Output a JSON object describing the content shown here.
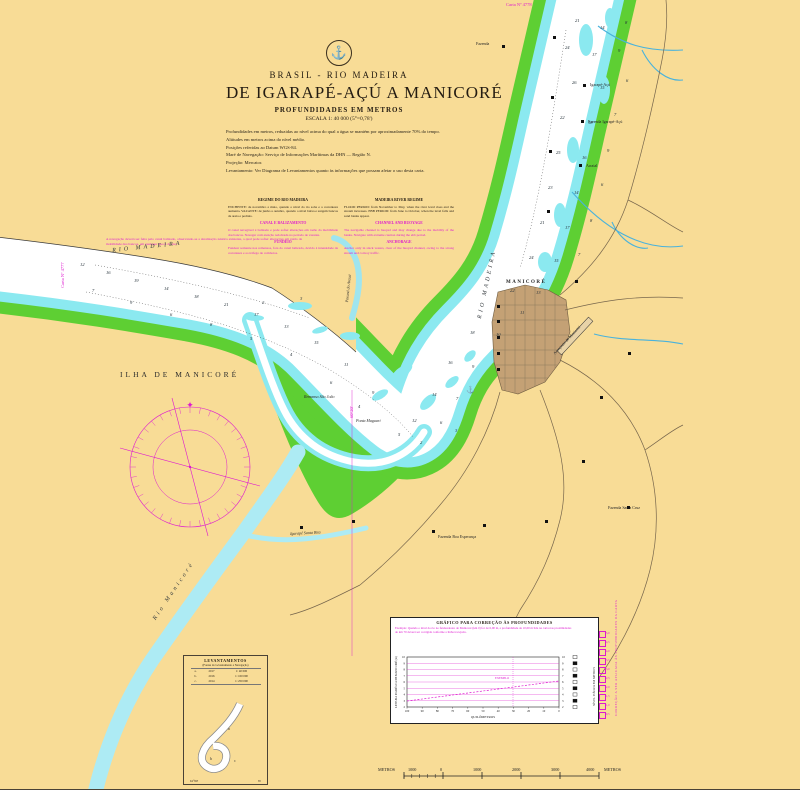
{
  "chart": {
    "country_line": "BRASIL - RIO MADEIRA",
    "title": "DE IGARAPÉ-AÇÚ A MANICORÉ",
    "subtitle1": "PROFUNDIDADES EM METROS",
    "subtitle2": "ESCALA 1: 40 000 (5°=0,78')",
    "emblem_icon": "anchor-icon",
    "notes": [
      "Profundidades em metros, reduzidas ao nível acima do qual a água se mantém por aproximadamente 70% do tempo.",
      "Altitudes em metros acima do nível médio.",
      "Posições referidas ao Datum WGS-84.",
      "Maré de Navegação: Serviço de Informações Marítimas da DHN — Região N.",
      "Projeção: Mercator.",
      "Levantamento: Ver Diagrama de Levantamentos quanto às informações que possam afetar o uso desta carta."
    ]
  },
  "notes_block": {
    "left": {
      "title": "REGIME DO RIO MADEIRA",
      "p1": "ENCHENTE: de novembro a maio, quando o nível do rio sobe e a correnteza aumenta. VAZANTE: de junho a outubro, quando o nível baixa e surgem bancos de areia e pedrais.",
      "h2": "CANAL E BALIZAMENTO",
      "p2": "O canal navegável é balizado e pode sofrer alterações em razão da mobilidade dos bancos. Navegar com atenção redobrada no período de vazante.",
      "h3": "FUNDEIO",
      "p3": "Fundear somente nos remansos, fora do canal balizado, devido à intensidade da correnteza e ao tráfego de comboios."
    },
    "right": {
      "title": "MADEIRA RIVER REGIME",
      "p1": "FLOOD PERIOD: from November to May, when the river level rises and the stream increases. EBB PERIOD: from June to October, when the level falls and sand banks appear.",
      "h2": "CHANNEL AND BUOYAGE",
      "p2": "The navigable channel is buoyed and may change due to the mobility of the banks. Navigate with extreme caution during the ebb period.",
      "h3": "ANCHORAGE",
      "p3": "Anchor only in slack waters, clear of the buoyed channel, owing to the strong stream and convoy traffic."
    }
  },
  "river_note": "A navegação deverá ser feita pelo canal balizado, observando-se a sinalização náutica existente, a qual pode sofrer alterações em razão da mobilidade dos bancos, em qualquer época do ano.",
  "map_labels": [
    {
      "t": "Carta Nº 4778",
      "x": 506,
      "y": 2,
      "c": "c-mag"
    },
    {
      "t": "Carta Nº 4777",
      "x": 60,
      "y": 288,
      "r": -90,
      "c": "c-mag"
    },
    {
      "t": "Fazenda",
      "x": 476,
      "y": 41,
      "c": "c-pl"
    },
    {
      "t": "Igarapé-Açú",
      "x": 590,
      "y": 82,
      "c": "c-pl"
    },
    {
      "t": "Fazenda Igarapé-Açú",
      "x": 588,
      "y": 119,
      "c": "c-pl"
    },
    {
      "t": "Arraial",
      "x": 586,
      "y": 163,
      "c": "c-pl"
    },
    {
      "t": "RIO MADEIRA",
      "x": 112,
      "y": 248,
      "r": -6,
      "c": "c-wat"
    },
    {
      "t": "RIO MADEIRA",
      "x": 477,
      "y": 318,
      "r": -78,
      "c": "c-wat"
    },
    {
      "t": "ILHA DE MANICORÉ",
      "x": 120,
      "y": 370,
      "c": "c-isl"
    },
    {
      "t": "MANICORÉ",
      "x": 506,
      "y": 280,
      "c": "c-city"
    },
    {
      "t": "Remanso São João",
      "x": 304,
      "y": 394,
      "c": "c-pli"
    },
    {
      "t": "Ponta Maguari",
      "x": 356,
      "y": 418,
      "c": "c-pli"
    },
    {
      "t": "Paraná do Arauá",
      "x": 344,
      "y": 302,
      "r": -84,
      "c": "c-pli"
    },
    {
      "t": "Rio Manicoré",
      "x": 152,
      "y": 618,
      "r": -56,
      "c": "c-wat"
    },
    {
      "t": "Igarapé Santa Rita",
      "x": 290,
      "y": 531,
      "r": -3,
      "c": "c-pli"
    },
    {
      "t": "Fazenda Santa Cruz",
      "x": 608,
      "y": 505,
      "c": "c-pl"
    },
    {
      "t": "Fazenda Boa Esperança",
      "x": 438,
      "y": 534,
      "c": "c-pl"
    },
    {
      "t": "Aeroporto de Manicoré",
      "x": 552,
      "y": 352,
      "r": -47,
      "c": "c-pl"
    },
    {
      "t": "60°20'",
      "x": 349,
      "y": 418,
      "r": -90,
      "c": "c-mag"
    }
  ],
  "soundings": [
    [
      575,
      18,
      "21"
    ],
    [
      600,
      25,
      "14"
    ],
    [
      625,
      20,
      "8"
    ],
    [
      565,
      45,
      "24"
    ],
    [
      592,
      52,
      "17"
    ],
    [
      618,
      48,
      "9"
    ],
    [
      572,
      80,
      "26"
    ],
    [
      600,
      85,
      "15"
    ],
    [
      626,
      78,
      "6"
    ],
    [
      560,
      115,
      "22"
    ],
    [
      588,
      120,
      "18"
    ],
    [
      614,
      112,
      "7"
    ],
    [
      556,
      150,
      "25"
    ],
    [
      582,
      155,
      "16"
    ],
    [
      607,
      148,
      "9"
    ],
    [
      548,
      185,
      "23"
    ],
    [
      574,
      190,
      "14"
    ],
    [
      601,
      182,
      "6"
    ],
    [
      540,
      220,
      "21"
    ],
    [
      565,
      225,
      "17"
    ],
    [
      590,
      218,
      "8"
    ],
    [
      529,
      255,
      "24"
    ],
    [
      554,
      258,
      "15"
    ],
    [
      578,
      252,
      "7"
    ],
    [
      510,
      288,
      "22"
    ],
    [
      536,
      290,
      "13"
    ],
    [
      470,
      330,
      "18"
    ],
    [
      496,
      332,
      "10"
    ],
    [
      448,
      360,
      "16"
    ],
    [
      472,
      364,
      "9"
    ],
    [
      432,
      392,
      "14"
    ],
    [
      456,
      396,
      "7"
    ],
    [
      412,
      418,
      "12"
    ],
    [
      440,
      420,
      "6"
    ],
    [
      80,
      262,
      "12"
    ],
    [
      106,
      270,
      "16"
    ],
    [
      134,
      278,
      "19"
    ],
    [
      164,
      286,
      "14"
    ],
    [
      194,
      294,
      "18"
    ],
    [
      224,
      302,
      "21"
    ],
    [
      254,
      312,
      "17"
    ],
    [
      284,
      324,
      "13"
    ],
    [
      314,
      340,
      "15"
    ],
    [
      344,
      362,
      "11"
    ],
    [
      372,
      390,
      "9"
    ],
    [
      92,
      288,
      "7"
    ],
    [
      130,
      300,
      "9"
    ],
    [
      170,
      312,
      "6"
    ],
    [
      210,
      322,
      "8"
    ],
    [
      250,
      336,
      "5"
    ],
    [
      290,
      352,
      "4"
    ],
    [
      330,
      380,
      "6"
    ],
    [
      358,
      404,
      "4"
    ],
    [
      398,
      432,
      "5"
    ],
    [
      420,
      440,
      "2"
    ],
    [
      455,
      428,
      "3"
    ],
    [
      520,
      310,
      "11"
    ],
    [
      300,
      296,
      "3"
    ],
    [
      262,
      300,
      "2"
    ]
  ],
  "buildings": [
    [
      502,
      45
    ],
    [
      553,
      36
    ],
    [
      551,
      96
    ],
    [
      549,
      150
    ],
    [
      547,
      210
    ],
    [
      583,
      84
    ],
    [
      581,
      120
    ],
    [
      579,
      164
    ],
    [
      575,
      280
    ],
    [
      628,
      352
    ],
    [
      600,
      396
    ],
    [
      582,
      460
    ],
    [
      545,
      520
    ],
    [
      483,
      524
    ],
    [
      432,
      530
    ],
    [
      627,
      506
    ],
    [
      352,
      520
    ],
    [
      300,
      526
    ],
    [
      497,
      305
    ],
    [
      497,
      320
    ],
    [
      497,
      336
    ],
    [
      497,
      352
    ],
    [
      497,
      368
    ]
  ],
  "graph": {
    "title": "GRÁFICO PARA CORREÇÃO ÀS PROFUNDIDADES",
    "example_line1": "Exemplo: Quando o nível do rio no fundeadouro de Manicoré (km 0) for de 6,00 m, a profundidade de 10,00 m lida na carta nas proximidades",
    "example_line2": "do km 70 deverá ser corrigida conforme a linha tracejada.",
    "ylabel": "LEITURA DA RÉGUA DE MANICORÉ (m)",
    "xlabel": "QUILÔMETROS",
    "right_axis_label": "NÍVEL D'ÁGUA EM METROS",
    "right_caption": "CORREÇÃO A SER APLICADA ÀS PROFUNDIDADES DA CARTA",
    "annotation": "EXEMPLO",
    "yticks": [
      "10",
      "9",
      "8",
      "7",
      "6",
      "5",
      "4",
      "3",
      "2"
    ],
    "xticks": [
      "100",
      "90",
      "80",
      "70",
      "60",
      "50",
      "40",
      "30",
      "20",
      "10",
      "0"
    ],
    "mbar_values": [
      "5,0",
      "4,5",
      "4,0",
      "3,5",
      "3,0",
      "2,5",
      "2,0",
      "1,5",
      "1,0",
      "0,5"
    ]
  },
  "chart_data": {
    "type": "line",
    "title": "GRÁFICO PARA CORREÇÃO ÀS PROFUNDIDADES",
    "xlabel": "QUILÔMETROS",
    "ylabel": "LEITURA DA RÉGUA DE MANICORÉ (m)",
    "x": [
      100,
      90,
      80,
      70,
      60,
      50,
      40,
      30,
      20,
      10,
      0
    ],
    "series": [
      {
        "name": "Correção (exemplo)",
        "values": [
          4.0,
          4.2,
          4.4,
          4.6,
          4.8,
          5.0,
          5.2,
          5.4,
          5.6,
          5.8,
          6.0
        ]
      }
    ],
    "ylim": [
      2,
      10
    ],
    "grid": true,
    "legend_position": "none"
  },
  "lev_inset": {
    "title": "LEVANTAMENTOS",
    "sub": "(Fontes do Levantamento e Navegação)",
    "rows": [
      [
        "a.",
        "2017",
        "1: 40 000"
      ],
      [
        "b.",
        "2016",
        "1: 100 000"
      ],
      [
        "c.",
        "2014",
        "1: 250 000"
      ]
    ],
    "bottom_left": "61°00'",
    "bottom_right": "W"
  },
  "scalebar": {
    "labels": [
      {
        "t": "METROS",
        "x": 378
      },
      {
        "t": "1000",
        "x": 408
      },
      {
        "t": "0",
        "x": 440
      },
      {
        "t": "1000",
        "x": 473
      },
      {
        "t": "2000",
        "x": 512
      },
      {
        "t": "3000",
        "x": 551
      },
      {
        "t": "4000",
        "x": 586
      },
      {
        "t": "METROS",
        "x": 604
      }
    ]
  },
  "colors": {
    "paper": "#F8DC96",
    "bank_green": "#5ECF33",
    "shallow_cyan": "#8BE9F0",
    "tributary": "#ADEBF4",
    "channel_white": "#FFFFFF",
    "town": "#C4A175",
    "magenta": "#DE1ACF",
    "road": "#77664C",
    "stream": "#49B2DC"
  }
}
